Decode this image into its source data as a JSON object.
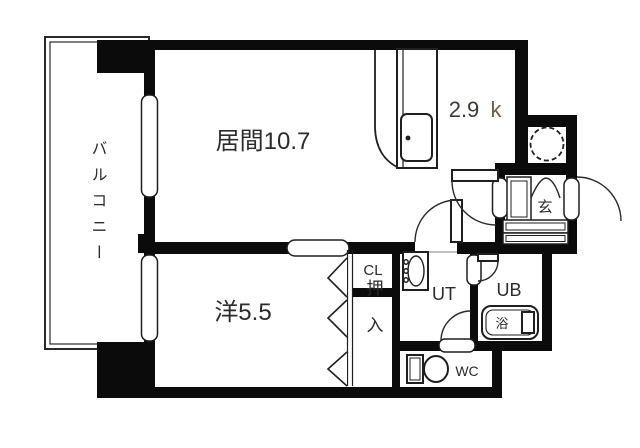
{
  "figure": {
    "kind": "apartment-floor-plan"
  },
  "colors": {
    "wall": "#0b0b0b",
    "line": "#1f1f1f",
    "text": "#2b2b2b",
    "kitchen_k_accent": "#6e6048",
    "background": "#ffffff"
  },
  "rooms": {
    "balcony": {
      "label": "バルコニー"
    },
    "living": {
      "label": "居間10.7"
    },
    "kitchen": {
      "size": "2.9",
      "unit": "k"
    },
    "western_room": {
      "label": "洋5.5"
    },
    "closet": {
      "label": "CL"
    },
    "oshiire": {
      "label": "押入"
    },
    "utility": {
      "label": "UT"
    },
    "unit_bath": {
      "label": "UB"
    },
    "bathtub": {
      "label": "浴"
    },
    "toilet": {
      "label": "WC"
    },
    "entrance": {
      "label": "玄"
    }
  }
}
